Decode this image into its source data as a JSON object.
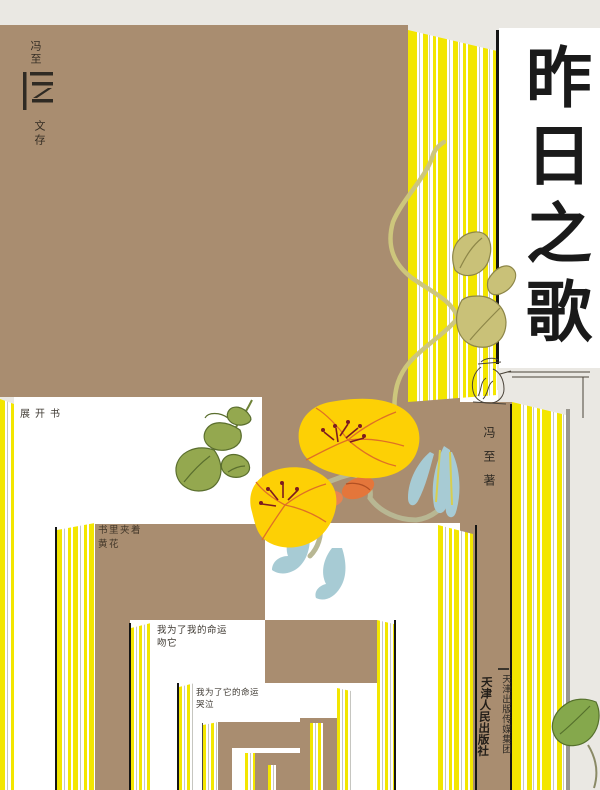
{
  "colors": {
    "background": "#eae8e3",
    "cover_tan": "#a98d70",
    "stripe_yellow": "#f3e600",
    "ink_black": "#151515",
    "leaf_green": "#93a74d",
    "leaf_olive": "#c9c178",
    "petal_blue": "#a7cbd4",
    "flower_yellow": "#fdd005",
    "bud_orange": "#e4763b"
  },
  "colophon": {
    "author": "冯至",
    "series": "文存"
  },
  "title": {
    "text": "昨日之歌"
  },
  "author": {
    "name": "冯至",
    "role": "著"
  },
  "captions": {
    "open_book": "展开书",
    "insert_1": "书里夹着",
    "insert_2": "黄花",
    "fate_mine_1": "我为了我的命运",
    "fate_mine_2": "吻它",
    "fate_its_1": "我为了它的命运",
    "fate_its_2": "哭泣"
  },
  "publisher": {
    "group": "天津出版传媒集团",
    "house": "天津人民出版社"
  }
}
